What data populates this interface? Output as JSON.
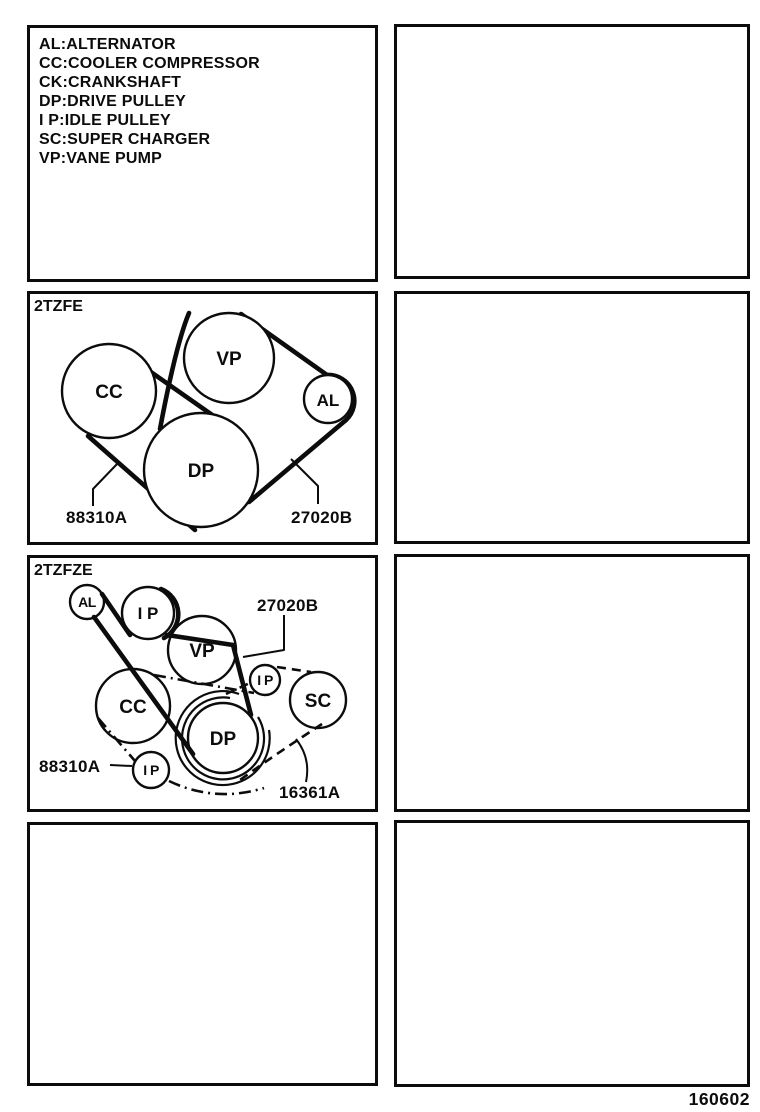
{
  "colors": {
    "ink": "#0c0c0c",
    "paper": "#ffffff"
  },
  "legend": {
    "items": [
      "AL:ALTERNATOR",
      "CC:COOLER COMPRESSOR",
      "CK:CRANKSHAFT",
      "DP:DRIVE PULLEY",
      "I P:IDLE PULLEY",
      "SC:SUPER CHARGER",
      "VP:VANE PUMP"
    ]
  },
  "diagram1": {
    "title": "2TZFE",
    "pulleys": {
      "cc": "CC",
      "vp": "VP",
      "al": "AL",
      "dp": "DP"
    },
    "parts": {
      "belt_88310a": "88310A",
      "belt_27020b": "27020B"
    }
  },
  "diagram2": {
    "title": "2TZFZE",
    "pulleys": {
      "al": "AL",
      "ip_top": "I P",
      "vp": "VP",
      "cc": "CC",
      "ip_right": "I P",
      "sc": "SC",
      "dp": "DP",
      "ip_bottom": "I P"
    },
    "parts": {
      "belt_27020b": "27020B",
      "belt_88310a": "88310A",
      "belt_16361a": "16361A"
    }
  },
  "footer": {
    "page_code": "160602"
  }
}
